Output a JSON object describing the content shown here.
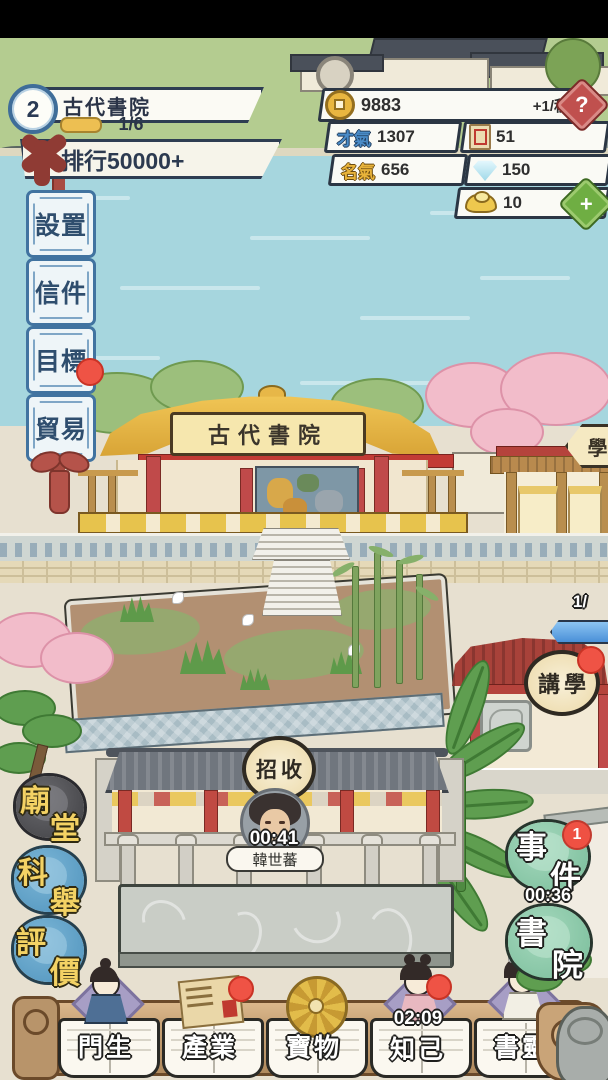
{
  "header": {
    "level": "2",
    "academy_name": "古代書院",
    "progress": "1/6",
    "rank_text": "排行50000+"
  },
  "resources": {
    "coins": "9883",
    "coin_rate": "+1/秒",
    "help": "?",
    "talent_label": "才氣",
    "talent": "1307",
    "tickets": "51",
    "fame_label": "名氣",
    "fame": "656",
    "gems": "150",
    "ingots": "10",
    "add": "+"
  },
  "side_menu": {
    "items": [
      {
        "label": "設置"
      },
      {
        "label": "信件"
      },
      {
        "label": "目標"
      },
      {
        "label": "貿易",
        "notification": true
      }
    ]
  },
  "scene": {
    "main_hall_plaque": "古代書院",
    "annex_sign": "學",
    "lecture_sign_1": "講",
    "lecture_sign_2": "學",
    "lecture_notification": true,
    "capacity": "1/",
    "recruit_sign_1": "招",
    "recruit_sign_2": "收",
    "npc_timer": "00:41",
    "npc_name": "韓世蕃"
  },
  "left_actions": [
    {
      "char1": "廟",
      "char2": "堂"
    },
    {
      "char1": "科",
      "char2": "舉"
    },
    {
      "char1": "評",
      "char2": "價"
    }
  ],
  "right_actions": [
    {
      "char1": "事",
      "char2": "件",
      "badge": "1",
      "timer": "00:36"
    },
    {
      "char1": "書",
      "char2": "院"
    }
  ],
  "bottom_bar": {
    "items": [
      {
        "label": "門生",
        "icon": "disciple-person"
      },
      {
        "label": "產業",
        "icon": "map-scroll",
        "notification": true
      },
      {
        "label": "寶物",
        "icon": "golden-wheel"
      },
      {
        "label": "知己",
        "icon": "lady",
        "timer": "02:09",
        "notification": true
      },
      {
        "label": "書靈",
        "icon": "book-spirit-lady"
      }
    ]
  },
  "colors": {
    "water": "#a6d6de",
    "grass": "#b4cc90",
    "ground": "#e7e0d0",
    "ui_border": "#2e3d52",
    "accent_red": "#ef5345",
    "gold_fill": "#edbf52",
    "menu_blue": "#4173a0",
    "blob_blue": "#5f9fc7",
    "blob_green": "#86c7a4",
    "blob_dark": "#4a4a4c",
    "wood_bar": "#c9a478"
  }
}
